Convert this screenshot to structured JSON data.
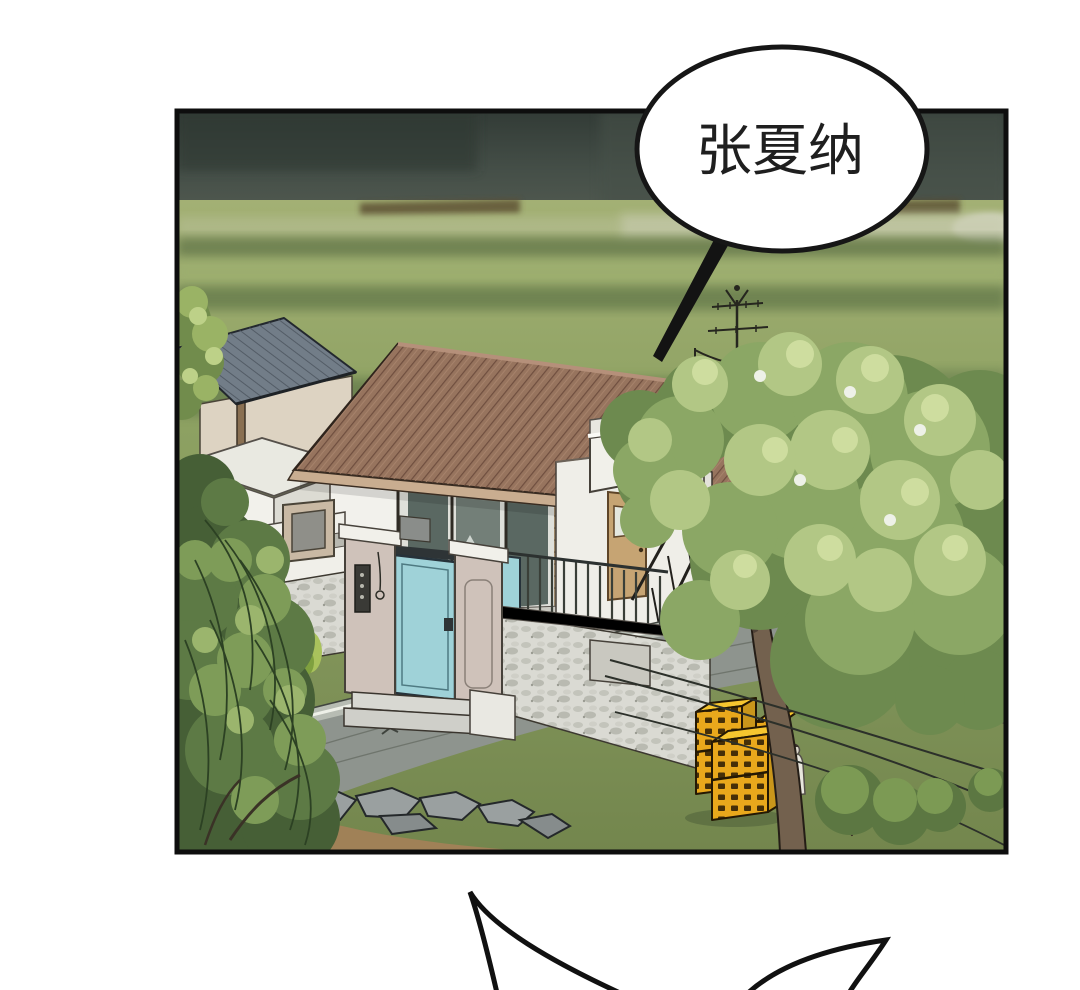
{
  "page": {
    "kind": "webtoon-comic-panel",
    "background_color": "#ffffff"
  },
  "panel": {
    "border_color": "#0e0e0e"
  },
  "speech_bubble": {
    "text": "张夏纳",
    "fill": "#ffffff",
    "stroke_color": "#161616"
  },
  "shout_bubble": {
    "text": "",
    "stroke_color": "#111111"
  },
  "scene": {
    "objects": [
      "dark-storm-sky",
      "green-fields",
      "house-brown-corrugated-roof",
      "neighbor-blue-roof",
      "flat-roof-wing",
      "veranda-glass-doors",
      "rooftop-terrace",
      "clay-jars",
      "tv-antenna",
      "power-lines",
      "stone-perimeter-wall",
      "gate-pillars",
      "teal-gate-door",
      "gate-steps",
      "tan-entry-door",
      "exterior-stairs",
      "gray-road",
      "curb-gutter",
      "rocks",
      "dirt",
      "yellow-crates",
      "small-white-figure",
      "large-tree",
      "left-willow-bush",
      "shrubs",
      "pink-gravel-path"
    ],
    "palette": {
      "sky_dark": "#3a443d",
      "field_green": "#93a566",
      "grass_dark": "#76894f",
      "roof_brown": "#97745e",
      "roof_stripe": "#6a4a3b",
      "neighbor_roof_blue": "#727d88",
      "wall_white": "#f2f1ec",
      "stone_wall": "#dadad3",
      "pillar_beige": "#cfc2ba",
      "gate_teal": "#9fd2d8",
      "door_tan": "#c6a473",
      "jar_brown": "#5f3e38",
      "crate_yellow": "#e9a81c",
      "crate_top": "#f6c62f",
      "road_gray": "#8e948e",
      "tree_mid": "#8ba765",
      "tree_light": "#b2c785",
      "bush_dark": "#465f36",
      "dirt_brown": "#a08157",
      "path_pink": "#ccb4a7"
    }
  }
}
